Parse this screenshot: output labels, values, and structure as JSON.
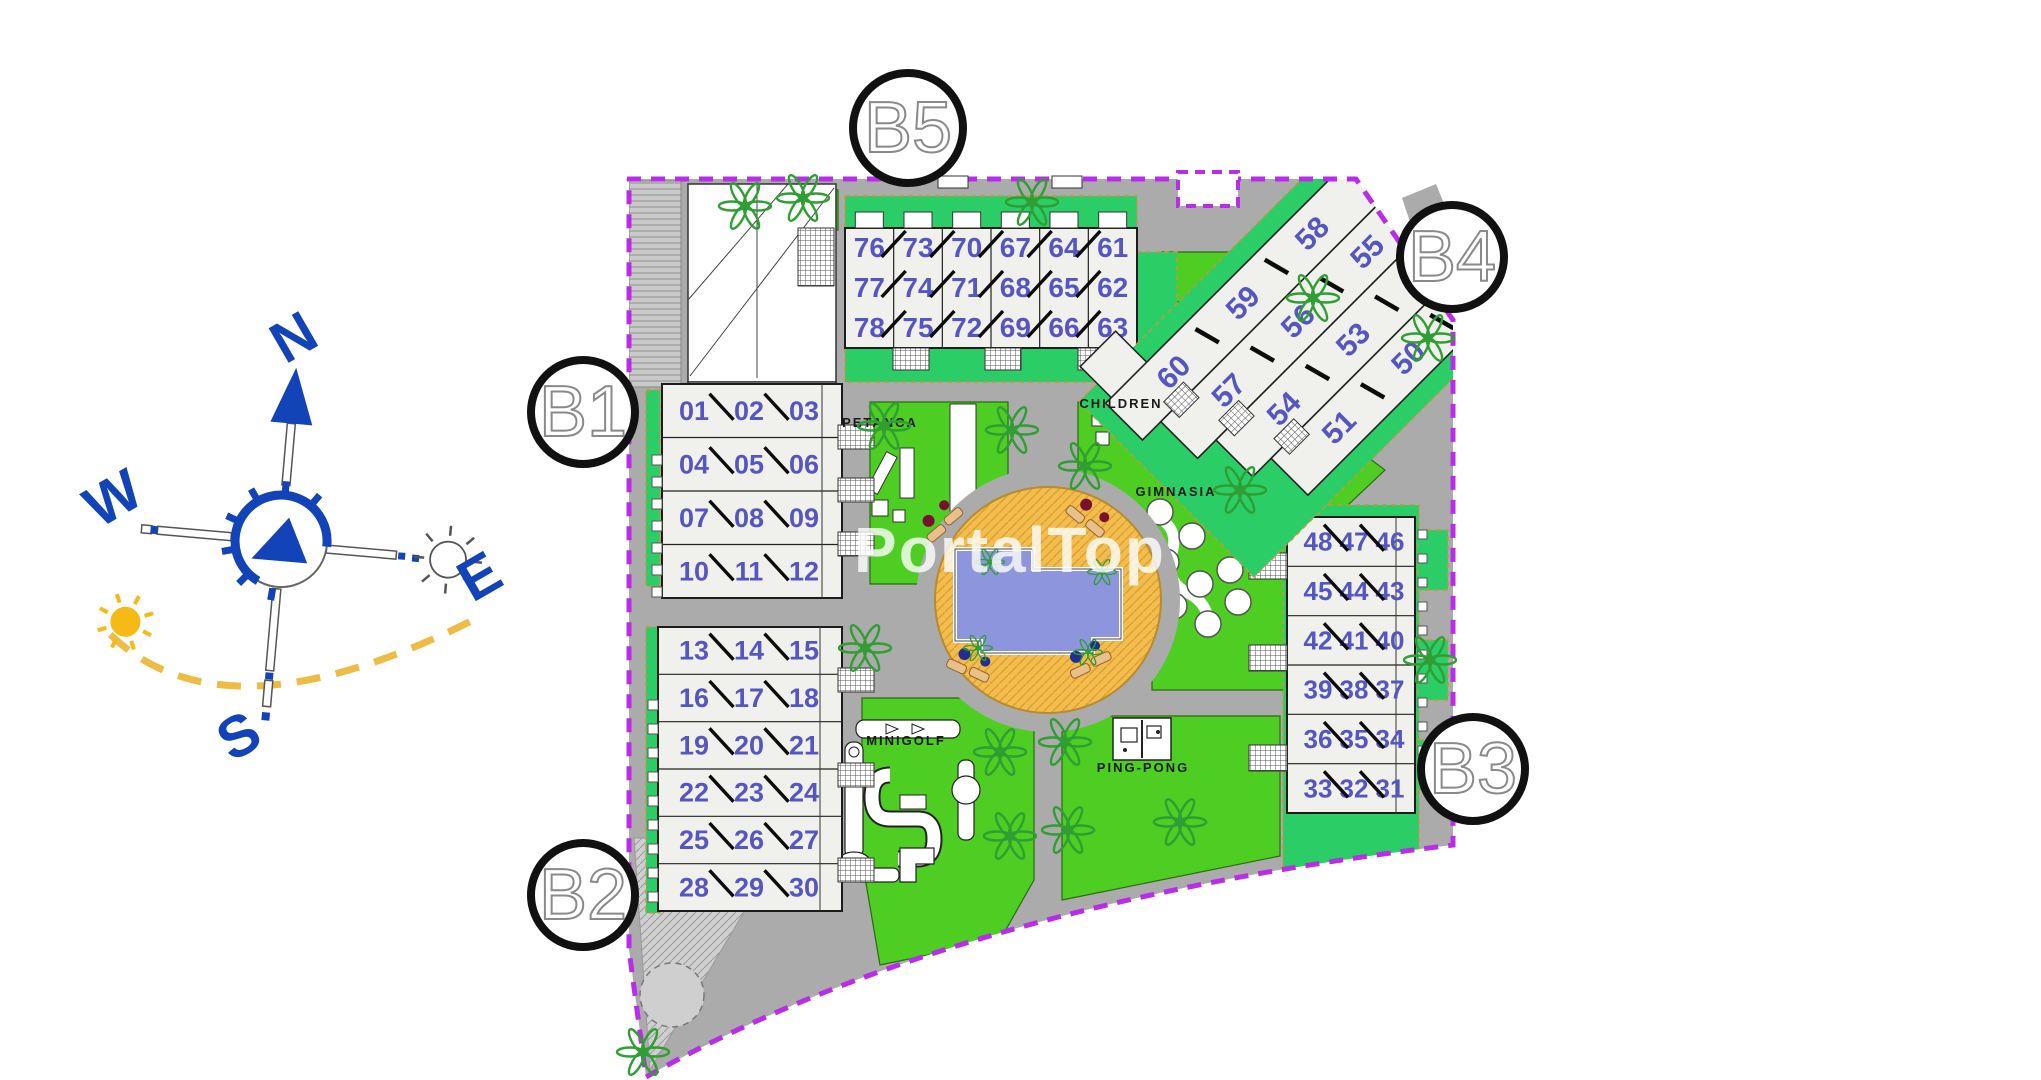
{
  "watermark": "PortalTop",
  "colors": {
    "lawn": "#4ecd22",
    "garden": "#2bce66",
    "road": "#ababab",
    "boundary": "#b92ce8",
    "unit_number": "#5656c2",
    "tree": "#2f9e33",
    "deck": "#f3bd4e",
    "deck_line": "#dba02f",
    "pool": "#8d95dc",
    "compass_blue": "#1243b8",
    "sun_yellow": "#f6b916",
    "arc_yellow": "#eebb44",
    "building_fill": "#f0f0ed",
    "building_stroke": "#1c1c1c",
    "circle_stroke": "#111111",
    "circle_letter": "#8a8a8a",
    "hatch": "#c9c9c9"
  },
  "compass": {
    "n": "N",
    "e": "E",
    "s": "S",
    "w": "W"
  },
  "block_markers": [
    {
      "id": "B5",
      "label": "B5",
      "cx": 908,
      "cy": 128,
      "r": 55
    },
    {
      "id": "B4",
      "label": "B4",
      "cx": 1452,
      "cy": 257,
      "r": 52
    },
    {
      "id": "B1",
      "label": "B1",
      "cx": 583,
      "cy": 412,
      "r": 52
    },
    {
      "id": "B2",
      "label": "B2",
      "cx": 583,
      "cy": 895,
      "r": 52
    },
    {
      "id": "B3",
      "label": "B3",
      "cx": 1473,
      "cy": 769,
      "r": 52
    }
  ],
  "buildings": [
    {
      "id": "b5",
      "kind": "cols",
      "x": 845,
      "y": 228,
      "w": 292,
      "h": 120,
      "slash": "/",
      "font": 28,
      "rows": [
        [
          "76",
          "73",
          "70",
          "67",
          "64",
          "61"
        ],
        [
          "77",
          "74",
          "71",
          "68",
          "65",
          "62"
        ],
        [
          "78",
          "75",
          "72",
          "69",
          "66",
          "63"
        ]
      ]
    },
    {
      "id": "b1",
      "kind": "rows",
      "x": 662,
      "y": 384,
      "w": 180,
      "h": 214,
      "slash": "\\",
      "font": 27,
      "numx": [
        694,
        749,
        804
      ],
      "corridor": 822,
      "rightStubs": [
        425,
        478,
        532
      ],
      "leftSquares": {
        "x": 652,
        "y0": 455,
        "n": 7,
        "step": 22
      },
      "rows": [
        [
          "01",
          "02",
          "03"
        ],
        [
          "04",
          "05",
          "06"
        ],
        [
          "07",
          "08",
          "09"
        ],
        [
          "10",
          "11",
          "12"
        ]
      ]
    },
    {
      "id": "b2",
      "kind": "rows",
      "x": 658,
      "y": 627,
      "w": 184,
      "h": 284,
      "slash": "\\",
      "font": 27,
      "numx": [
        694,
        749,
        804
      ],
      "corridor": 820,
      "rightStubs": [
        668,
        763,
        858
      ],
      "leftSquares": {
        "x": 648,
        "y0": 700,
        "n": 9,
        "step": 24
      },
      "rows": [
        [
          "13",
          "14",
          "15"
        ],
        [
          "16",
          "17",
          "18"
        ],
        [
          "19",
          "20",
          "21"
        ],
        [
          "22",
          "23",
          "24"
        ],
        [
          "25",
          "26",
          "27"
        ],
        [
          "28",
          "29",
          "30"
        ]
      ]
    },
    {
      "id": "b3",
      "kind": "rows",
      "x": 1287,
      "y": 517,
      "w": 128,
      "h": 296,
      "slash": "\\",
      "font": 26,
      "numx": [
        1318,
        1354,
        1390
      ],
      "corridor": 1396,
      "leftStubs": [
        553,
        645,
        745
      ],
      "rightSquares": {
        "x": 1418,
        "y0": 530,
        "n": 11,
        "step": 24
      },
      "rows": [
        [
          "48",
          "47",
          "46"
        ],
        [
          "45",
          "44",
          "43"
        ],
        [
          "42",
          "41",
          "40"
        ],
        [
          "39",
          "38",
          "37"
        ],
        [
          "36",
          "35",
          "34"
        ],
        [
          "33",
          "32",
          "31"
        ]
      ]
    },
    {
      "id": "b4",
      "kind": "stairs",
      "cx": 1298,
      "cy": 358,
      "rot": -45,
      "rowW": 336,
      "rowH": 52,
      "shift": 26,
      "font": 30,
      "rows": [
        [
          "60",
          "59",
          "58"
        ],
        [
          "57",
          "56",
          "55"
        ],
        [
          "54",
          "53",
          "52"
        ],
        [
          "51",
          "50",
          "49"
        ]
      ]
    }
  ],
  "amenities": [
    {
      "id": "petanca",
      "label": "PETANCA",
      "x": 880,
      "y": 427
    },
    {
      "id": "children",
      "label": "CHILDREN",
      "x": 1121,
      "y": 408
    },
    {
      "id": "gimnasia",
      "label": "GIMNASIA",
      "x": 1176,
      "y": 496
    },
    {
      "id": "minigolf",
      "label": "MINIGOLF",
      "x": 906,
      "y": 745
    },
    {
      "id": "ping-pong",
      "label": "PING-PONG",
      "x": 1143,
      "y": 772
    }
  ],
  "trees": [
    [
      745,
      206
    ],
    [
      803,
      198
    ],
    [
      1032,
      202
    ],
    [
      1313,
      298
    ],
    [
      1428,
      338
    ],
    [
      884,
      426
    ],
    [
      1012,
      430
    ],
    [
      1085,
      466
    ],
    [
      1240,
      490
    ],
    [
      865,
      648
    ],
    [
      1000,
      752
    ],
    [
      1065,
      742
    ],
    [
      1010,
      836
    ],
    [
      1068,
      830
    ],
    [
      1180,
      822
    ],
    [
      1430,
      660
    ],
    [
      643,
      1052
    ],
    [
      990,
      562,
      0.55
    ],
    [
      1102,
      572,
      0.55
    ],
    [
      978,
      648,
      0.55
    ],
    [
      1088,
      652,
      0.55
    ]
  ]
}
